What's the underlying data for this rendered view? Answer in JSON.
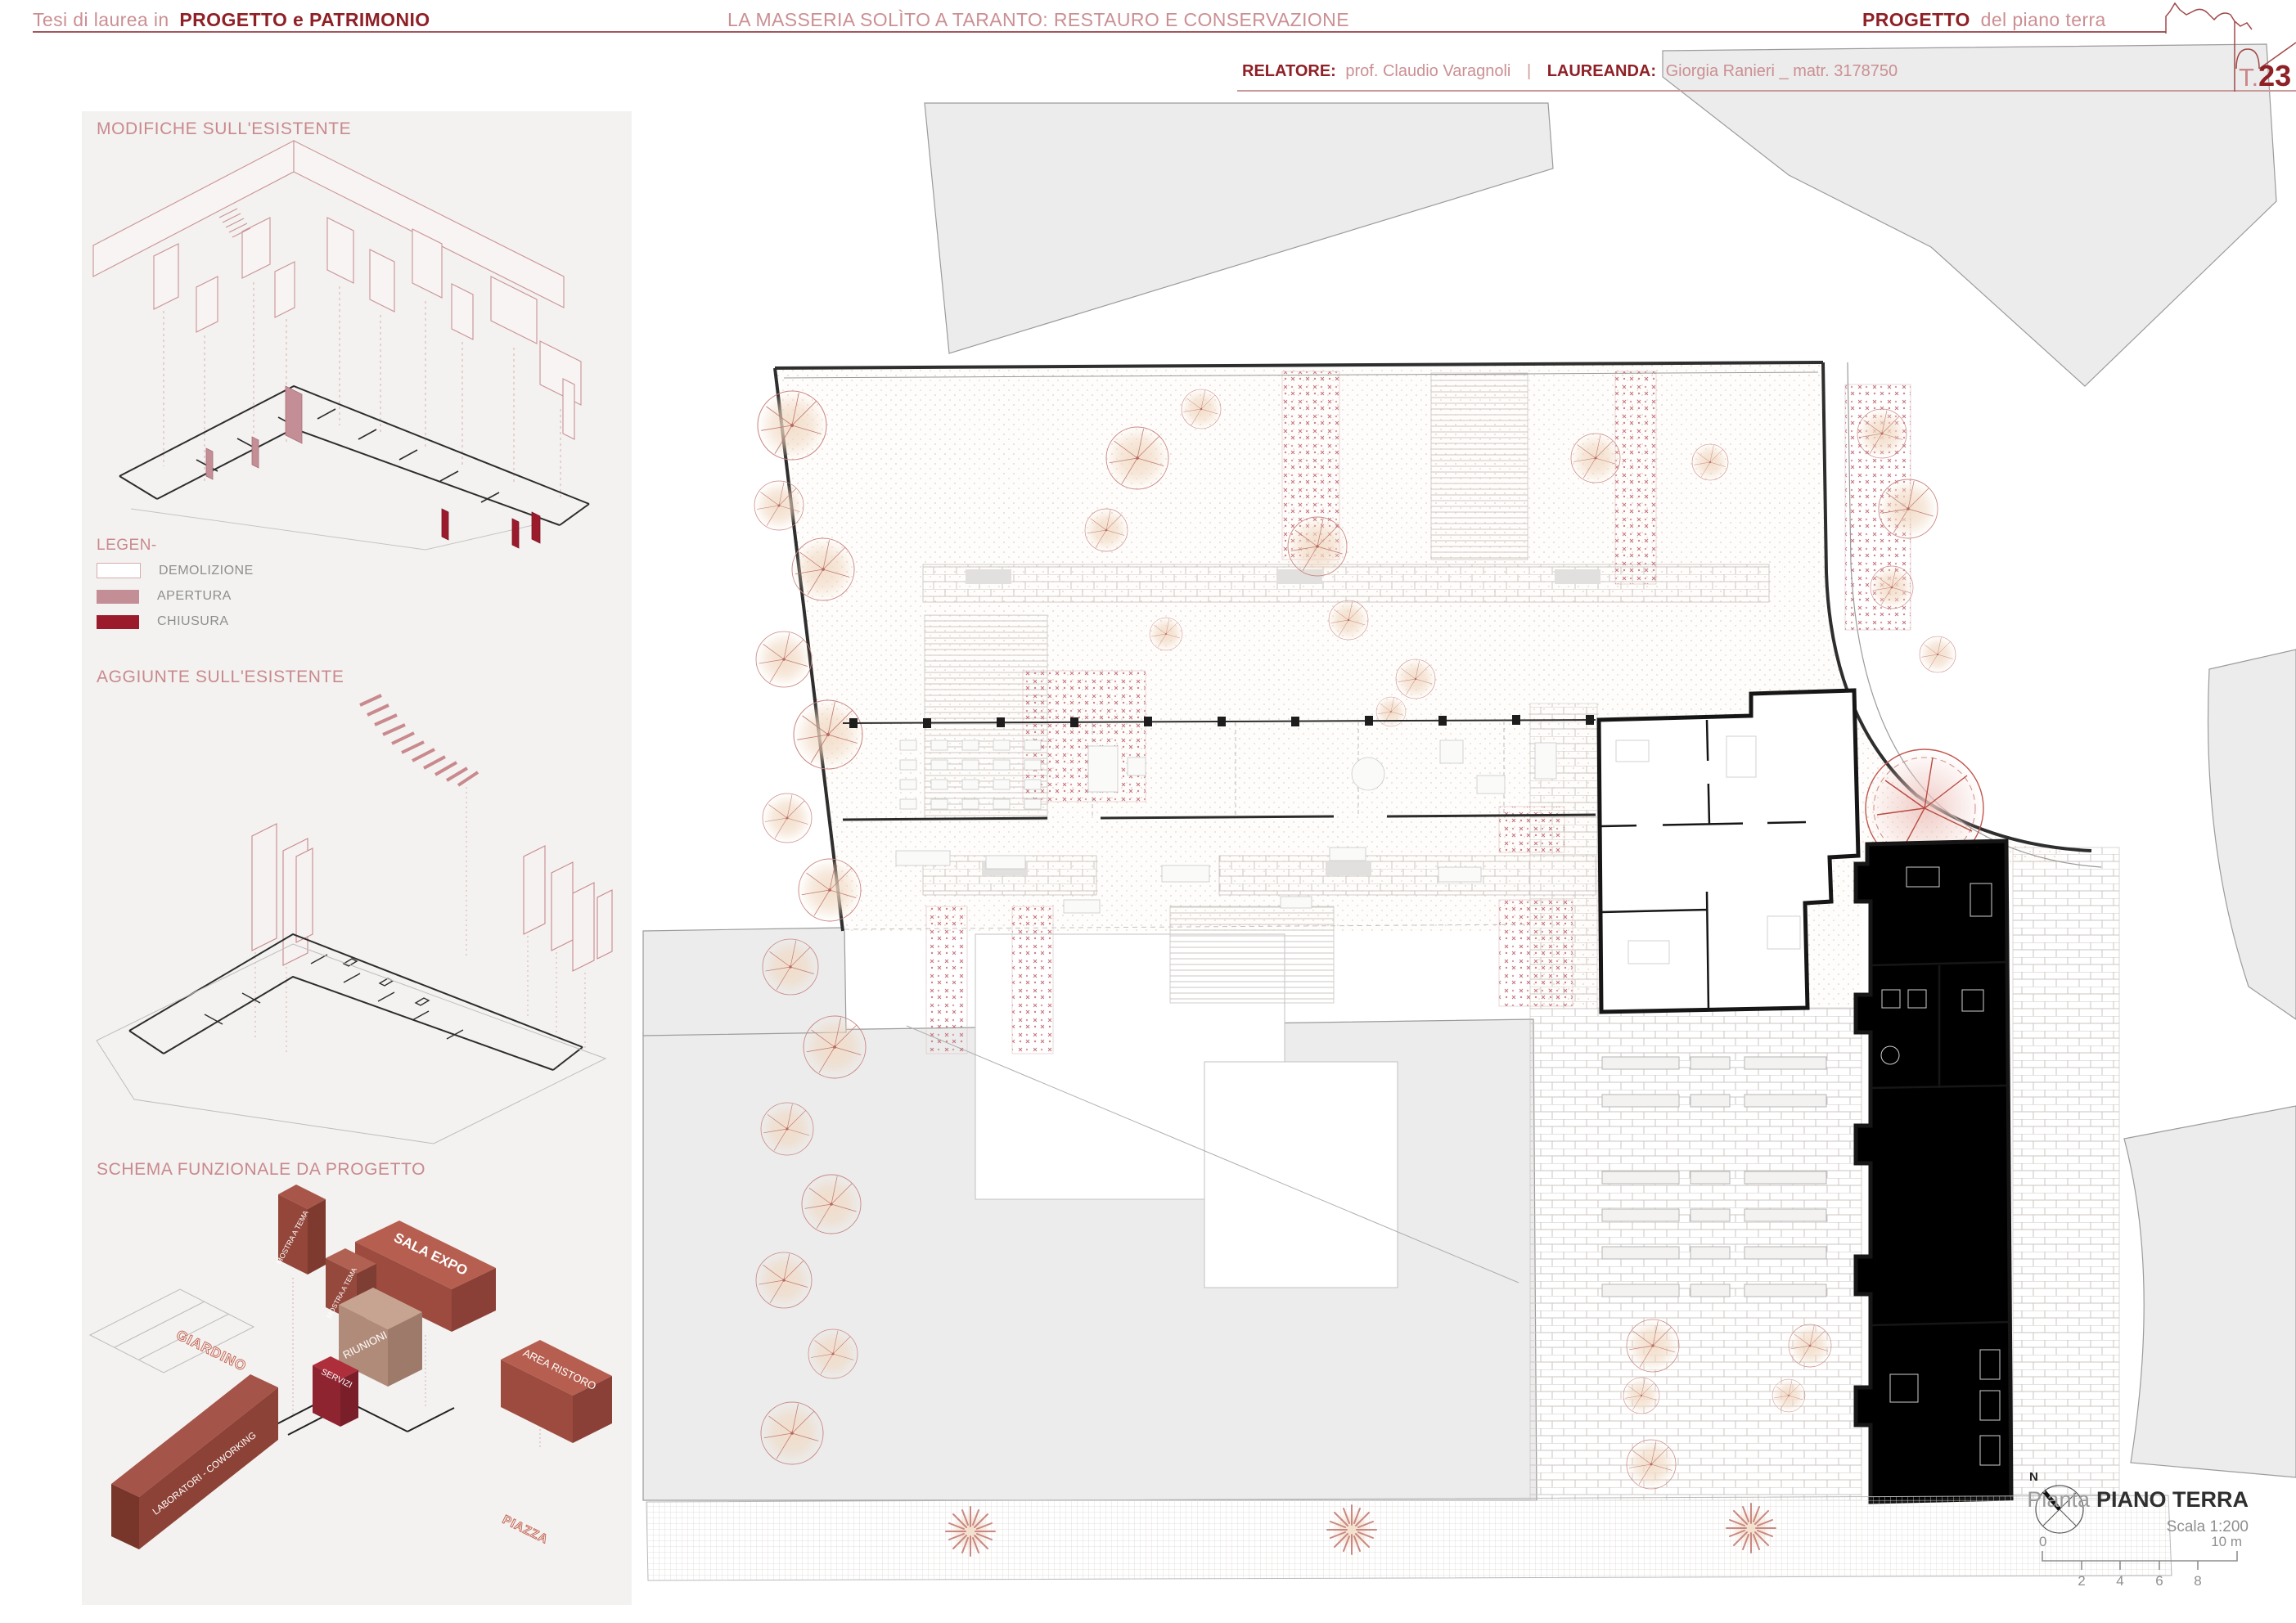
{
  "header": {
    "course_prefix": "Tesi di laurea in",
    "course_title": "PROGETTO e PATRIMONIO",
    "project_title": "LA MASSERIA SOLÌTO A TARANTO: RESTAURO E CONSERVAZIONE",
    "sheet_subject": "PROGETTO",
    "sheet_subject_suffix": "del piano terra",
    "relatore_label": "RELATORE:",
    "relatore_value": "prof. Claudio Varagnoli",
    "separator": "|",
    "laureanda_label": "LAUREANDA:",
    "laureanda_value": "Giorgia Ranieri _ matr. 3178750",
    "sheet_prefix": "T.",
    "sheet_number": "23"
  },
  "sidebar": {
    "modifiche_title": "MODIFICHE SULL'ESISTENTE",
    "legend_title": "LEGEN-",
    "legend_items": [
      {
        "label": "DEMOLIZIONE",
        "swatch": "#ffffff",
        "border": "#d8aab0"
      },
      {
        "label": "APERTURA",
        "swatch": "#c48e96"
      },
      {
        "label": "CHIUSURA",
        "swatch": "#9b1b2c"
      }
    ],
    "aggiunte_title": "AGGIUNTE SULL'ESISTENTE",
    "schema_title": "SCHEMA FUNZIONALE DA PROGETTO",
    "schema_labels": {
      "mostra_back": "MOSTRA A TEMA",
      "mostra_front": "MOSTRA A TEMA",
      "sala_expo": "SALA EXPO",
      "riunioni": "RIUNIONI",
      "giardino": "GIARDINO",
      "servizi": "SERVIZI",
      "area_ristoro": "AREA RISTORO",
      "laboratori": "LABORATORI - COWORKING",
      "piazza": "PIAZZA"
    }
  },
  "titleblock": {
    "north_label": "N",
    "caption_prefix": "Pianta",
    "caption_title": "PIANO TERRA",
    "scale_text": "Scala 1:200",
    "scalebar": {
      "start": "0",
      "ticks": [
        "2",
        "4",
        "6",
        "8"
      ],
      "end": "10 m"
    }
  },
  "colors": {
    "accent_dark": "#8e2026",
    "accent_light": "#c9898d",
    "apertura": "#c48e96",
    "chiusura": "#9b1b2c",
    "panel_bg": "#f3f2f0",
    "context_gray": "#ececec"
  }
}
